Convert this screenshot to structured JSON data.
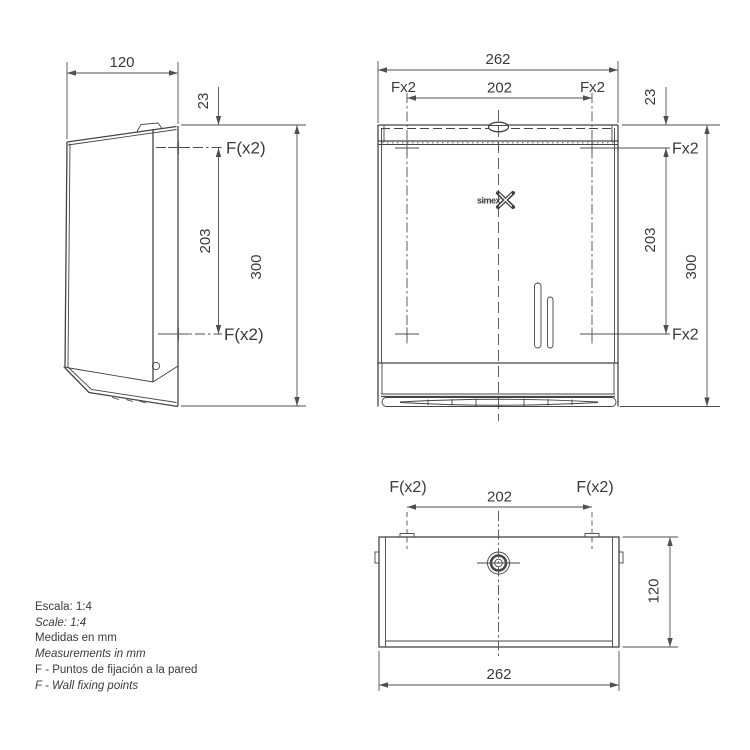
{
  "views": {
    "side": {
      "dim_width": "120",
      "dim_offset_top": "23",
      "dim_fixing_spacing": "203",
      "dim_height": "300",
      "label_fixing_top": "F(x2)",
      "label_fixing_bottom": "F(x2)"
    },
    "front": {
      "dim_width": "262",
      "dim_fixing_span": "202",
      "label_fixing_top_left": "Fx2",
      "label_fixing_top_right": "Fx2",
      "dim_offset_top": "23",
      "label_fixing_right_upper": "Fx2",
      "dim_fixing_spacing": "203",
      "dim_height": "300",
      "label_fixing_right_lower": "Fx2",
      "brand_logo": "simex"
    },
    "bottom": {
      "label_fixing_left": "F(x2)",
      "label_fixing_right": "F(x2)",
      "dim_fixing_span": "202",
      "dim_depth": "120",
      "dim_width": "262"
    }
  },
  "notes": [
    {
      "text": "Escala: 1:4",
      "lang": "es"
    },
    {
      "text": "Scale: 1:4",
      "lang": "en"
    },
    {
      "text": "Medidas en mm",
      "lang": "es"
    },
    {
      "text": "Measurements in mm",
      "lang": "en"
    },
    {
      "text": "F - Puntos de fijación a la pared",
      "lang": "es"
    },
    {
      "text": "F - Wall fixing points",
      "lang": "en"
    }
  ],
  "colors": {
    "line": "#454545",
    "dim_line": "#4f4f4f",
    "text": "#3a3a3a",
    "background": "#ffffff"
  }
}
